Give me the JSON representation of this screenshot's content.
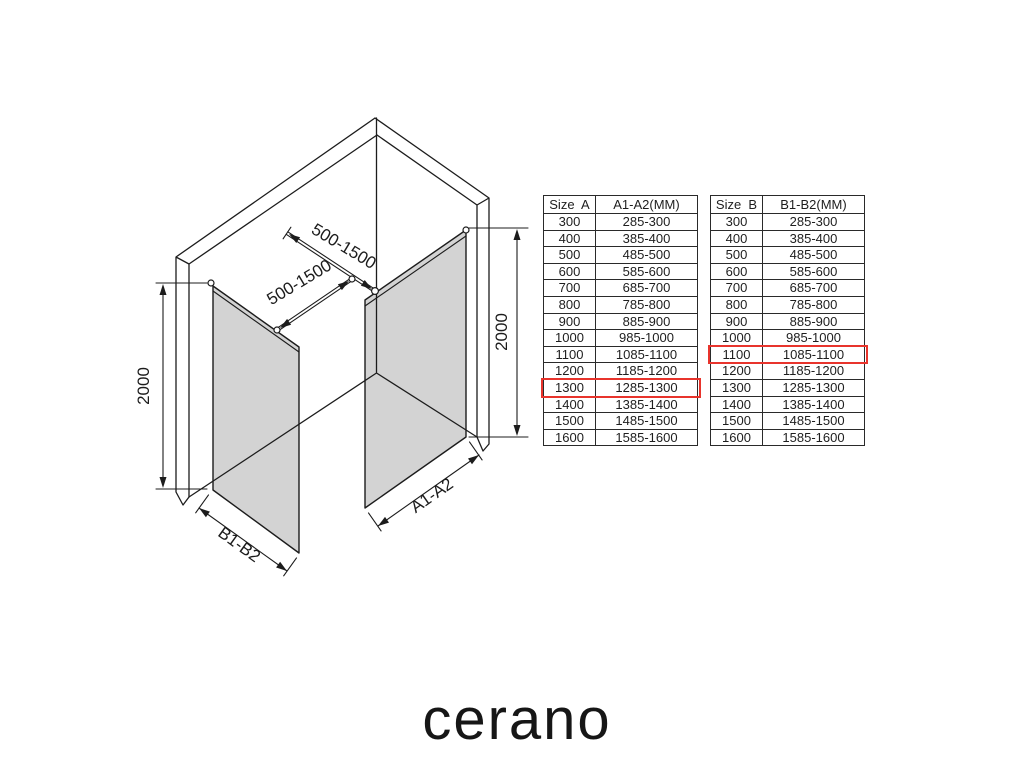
{
  "brand": {
    "logo_text": "cerano"
  },
  "highlight_color": "#e8342c",
  "diagram": {
    "line_color": "#1c1c1c",
    "glass_color": "#d3d3d3",
    "labels": {
      "support_bar_top": "500-1500",
      "support_bar_bottom": "500-1500",
      "height_left": "2000",
      "height_right": "2000",
      "panel_width_left": "B1-B2",
      "panel_width_right": "A1-A2"
    }
  },
  "tables": [
    {
      "name": "Size A table",
      "headers": [
        "Size  A",
        "A1-A2(MM)"
      ],
      "rows": [
        [
          "300",
          "285-300"
        ],
        [
          "400",
          "385-400"
        ],
        [
          "500",
          "485-500"
        ],
        [
          "600",
          "585-600"
        ],
        [
          "700",
          "685-700"
        ],
        [
          "800",
          "785-800"
        ],
        [
          "900",
          "885-900"
        ],
        [
          "1000",
          "985-1000"
        ],
        [
          "1100",
          "1085-1100"
        ],
        [
          "1200",
          "1185-1200"
        ],
        [
          "1300",
          "1285-1300"
        ],
        [
          "1400",
          "1385-1400"
        ],
        [
          "1500",
          "1485-1500"
        ],
        [
          "1600",
          "1585-1600"
        ]
      ],
      "highlighted_row": 10
    },
    {
      "name": "Size B table",
      "headers": [
        "Size  B",
        "B1-B2(MM)"
      ],
      "rows": [
        [
          "300",
          "285-300"
        ],
        [
          "400",
          "385-400"
        ],
        [
          "500",
          "485-500"
        ],
        [
          "600",
          "585-600"
        ],
        [
          "700",
          "685-700"
        ],
        [
          "800",
          "785-800"
        ],
        [
          "900",
          "885-900"
        ],
        [
          "1000",
          "985-1000"
        ],
        [
          "1100",
          "1085-1100"
        ],
        [
          "1200",
          "1185-1200"
        ],
        [
          "1300",
          "1285-1300"
        ],
        [
          "1400",
          "1385-1400"
        ],
        [
          "1500",
          "1485-1500"
        ],
        [
          "1600",
          "1585-1600"
        ]
      ],
      "highlighted_row": 8
    }
  ]
}
